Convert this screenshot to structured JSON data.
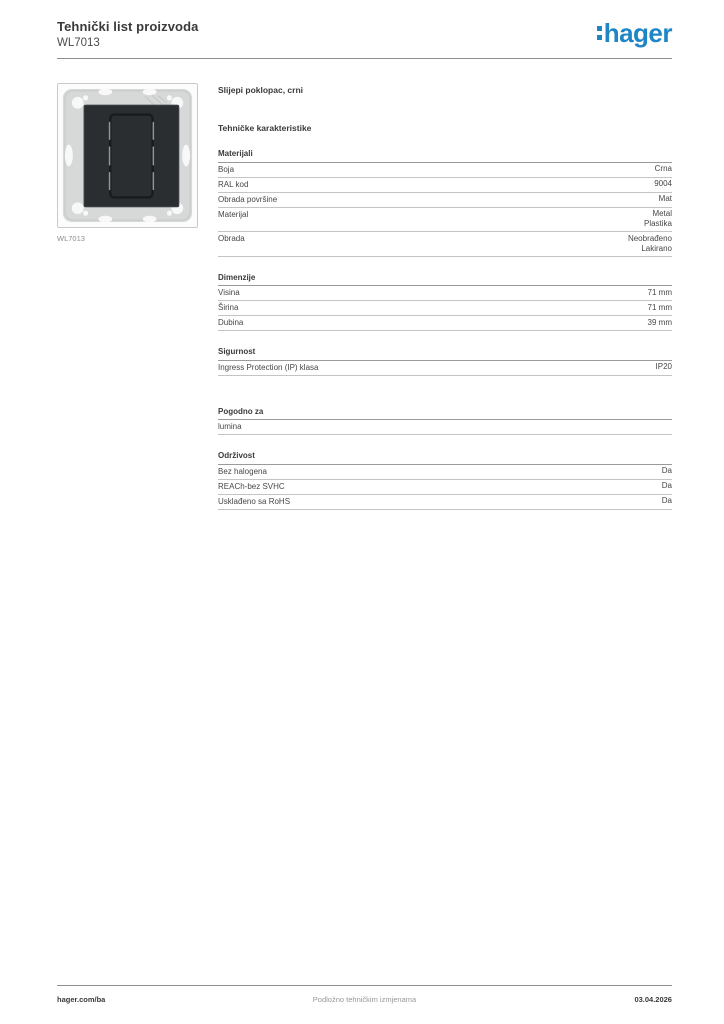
{
  "brand_color": "#1f86c5",
  "header": {
    "title": "Tehnički list proizvoda",
    "product_code": "WL7013",
    "logo_text": "hager"
  },
  "product": {
    "name": "Slijepi poklopac, crni",
    "image_caption": "WL7013"
  },
  "content": {
    "section_title": "Tehničke karakteristike",
    "sections": [
      {
        "title": "Materijali",
        "rows": [
          {
            "label": "Boja",
            "value": "Crna"
          },
          {
            "label": "RAL kod",
            "value": "9004"
          },
          {
            "label": "Obrada površine",
            "value": "Mat"
          },
          {
            "label": "Materijal",
            "value": [
              "Metal",
              "Plastika"
            ]
          },
          {
            "label": "Obrada",
            "value": [
              "Neobrađeno",
              "Lakirano"
            ]
          }
        ]
      },
      {
        "title": "Dimenzije",
        "rows": [
          {
            "label": "Visina",
            "value": "71 mm"
          },
          {
            "label": "Širina",
            "value": "71 mm"
          },
          {
            "label": "Dubina",
            "value": "39 mm"
          }
        ]
      },
      {
        "title": "Sigurnost",
        "rows": [
          {
            "label": "Ingress Protection (IP) klasa",
            "value": "IP20"
          }
        ]
      },
      {
        "title": "Pogodno za",
        "rows": [
          {
            "label": "lumina",
            "value": ""
          }
        ]
      },
      {
        "title": "Održivost",
        "rows": [
          {
            "label": "Bez halogena",
            "value": "Da"
          },
          {
            "label": "REACh-bez SVHC",
            "value": "Da"
          },
          {
            "label": "Usklađeno sa RoHS",
            "value": "Da"
          }
        ]
      }
    ]
  },
  "footer": {
    "left": "hager.com/ba",
    "center": "Podložno tehničkim izmjenama",
    "right": "03.04.2026"
  }
}
